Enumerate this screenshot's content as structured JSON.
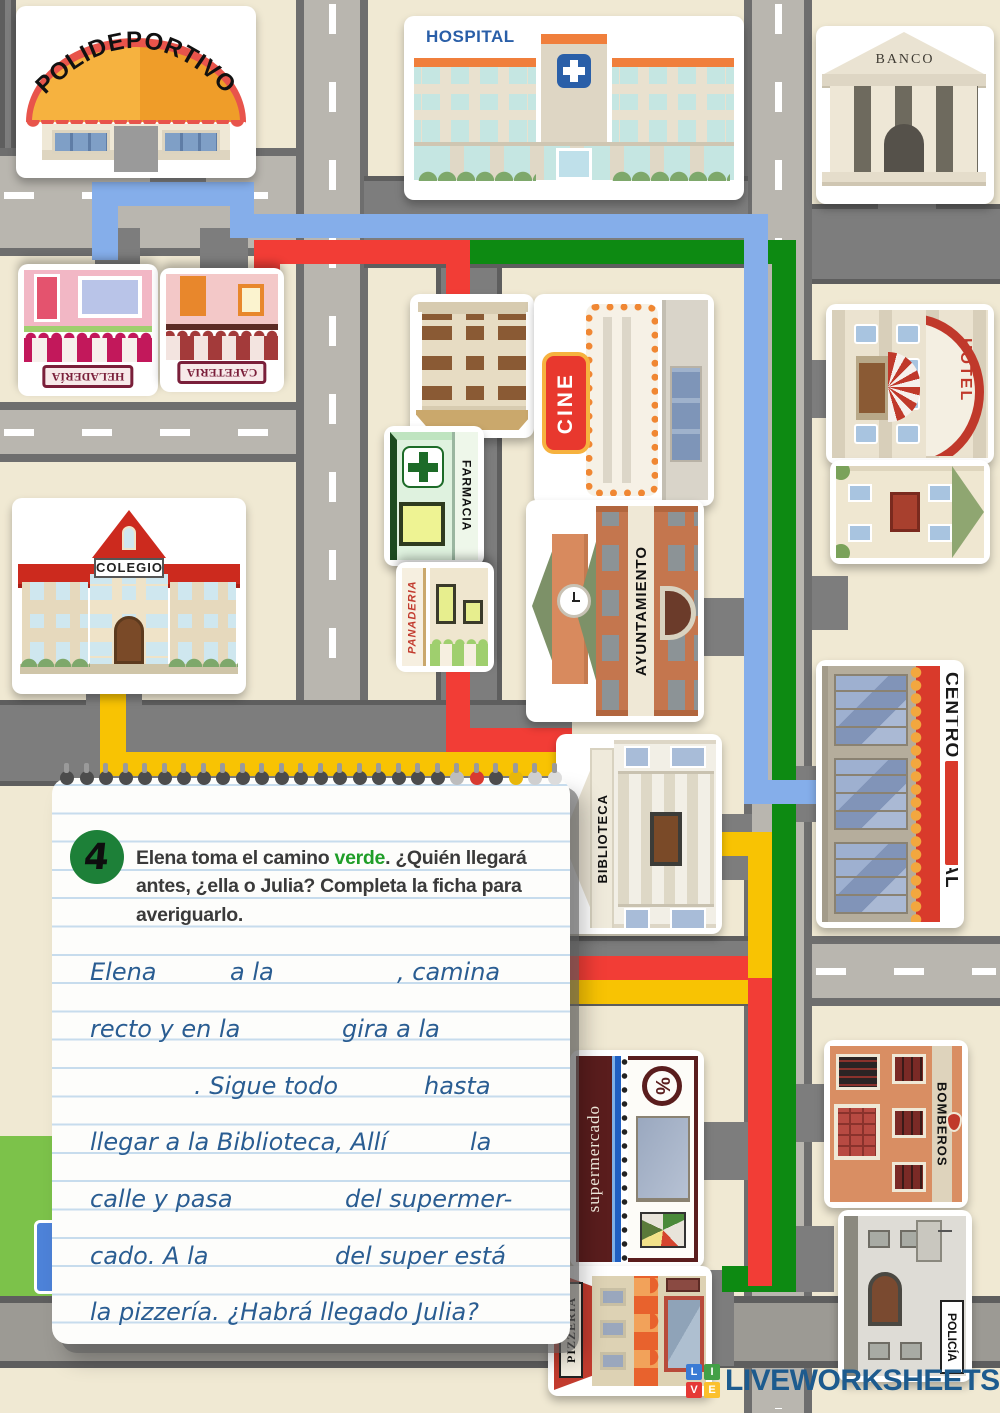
{
  "map": {
    "buildings": {
      "polideportivo": "POLIDEPORTIVO",
      "hospital": "HOSPITAL",
      "banco": "BANCO",
      "heladeria": "HELADERÍA",
      "cafeteria": "CAFETERIA",
      "farmacia": "FARMACIA",
      "panaderia": "PANADERIA",
      "cine": "CINE",
      "ayuntamiento": "AYUNTAMIENTO",
      "hotel": "HOTEL",
      "colegio": "COLEGIO",
      "centro_comercial": "CENTRO COMERCIAL",
      "biblioteca": "BIBLIOTECA",
      "supermercado": "supermercado",
      "supermercado_badge": "%",
      "bomberos": "BOMBEROS",
      "policia": "POLICÍA",
      "pizzeria": "PIZZERIA"
    },
    "route_colors": {
      "blue": "#85aeea",
      "red": "#f23d36",
      "green": "#0d8a12",
      "yellow": "#f8c303"
    }
  },
  "note": {
    "number": "4",
    "instruction": {
      "pre": "Elena toma el camino ",
      "highlight": "verde",
      "post": ".  ¿Quién llegará",
      "line2": "antes, ¿ella o Julia? Completa la ficha para",
      "line3": "averiguarlo."
    },
    "lines": {
      "l1a": "Elena",
      "l1b": "a la",
      "l1c": ", camina",
      "l2a": "recto y en la",
      "l2b": "gira a la",
      "l3a": ". Sigue todo",
      "l3b": "hasta",
      "l4a": "llegar a la Biblioteca, Allí",
      "l4b": "la",
      "l5a": "calle y pasa",
      "l5b": "del supermer-",
      "l6a": "cado. A la",
      "l6b": "del super está",
      "l7a": "la pizzería. ¿Habrá llegado Julia?"
    }
  },
  "footer": {
    "tiles": [
      "L",
      "I",
      "V",
      "E"
    ],
    "brand": "LIVEWORKSHEETS"
  }
}
